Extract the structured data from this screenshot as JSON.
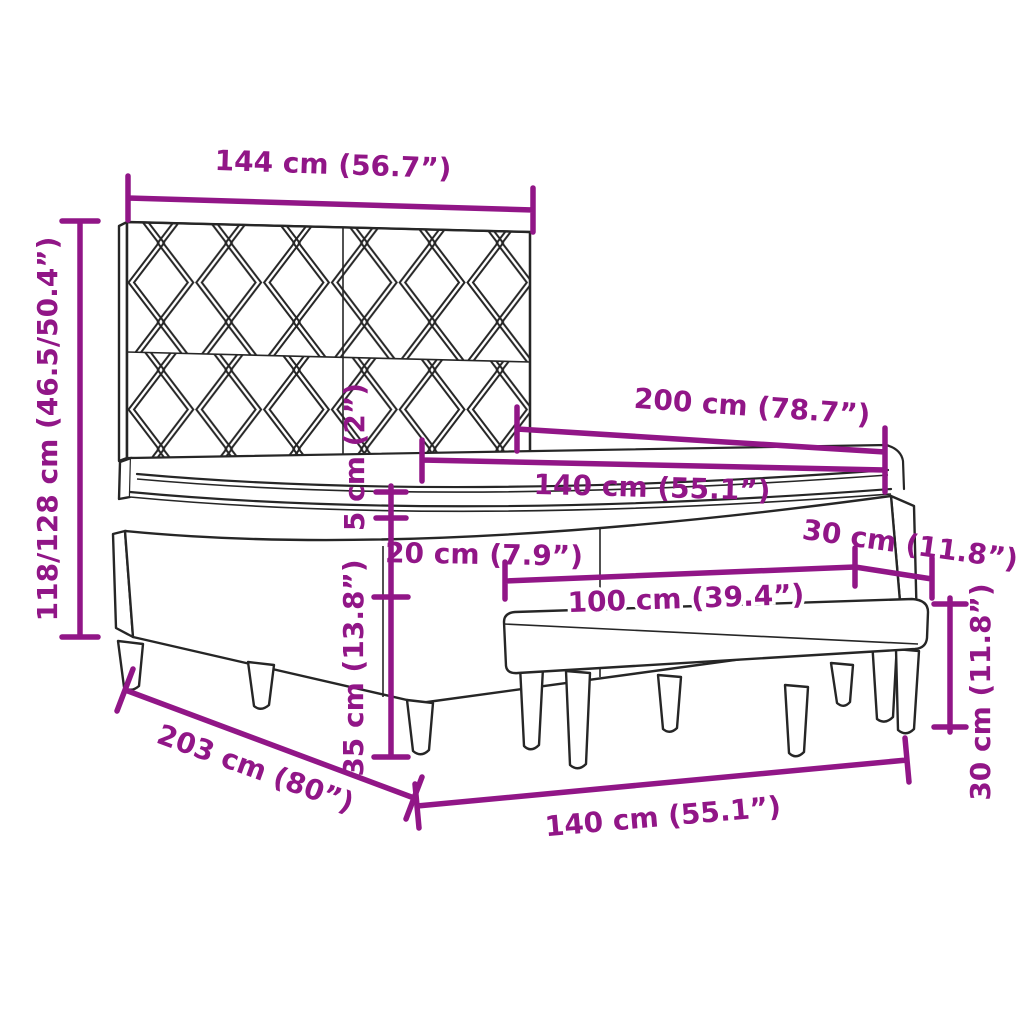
{
  "diagram": {
    "type": "product-dimension-diagram",
    "subject": "box spring bed with patterned headboard, mattress topper and bench",
    "colors": {
      "dimension_lines": "#911687",
      "drawing_lines": "#262626",
      "background": "#ffffff"
    },
    "dimensions": {
      "headboard_width": "144 cm (56.7”)",
      "overall_height": "118/128 cm (46.5/50.4”)",
      "bed_length": "200 cm (78.7”)",
      "mattress_width": "140 cm (55.1”)",
      "topper_thickness": "5 cm (2”)",
      "mattress_thickness": "20 cm (7.9”)",
      "base_height": "35 cm (13.8”)",
      "bench_length": "100 cm (39.4”)",
      "bench_depth": "30 cm (11.8”)",
      "bench_height": "30 cm (11.8”)",
      "bed_depth": "203 cm (80”)",
      "bed_width": "140 cm (55.1”)"
    }
  }
}
